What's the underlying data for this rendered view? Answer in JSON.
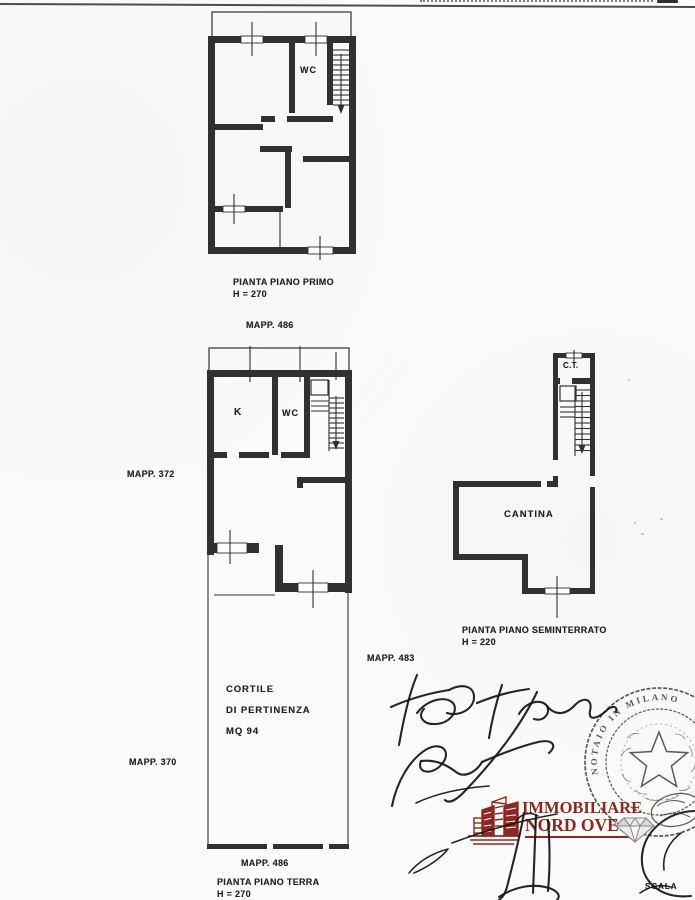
{
  "colors": {
    "ink": "#222222",
    "logo_red": "#8e2722",
    "stamp_ink": "#3f3f3f",
    "paper": "#fbfbf9"
  },
  "plans": {
    "primo": {
      "caption": "PIANTA PIANO PRIMO",
      "height": "H = 270",
      "mapp": "MAPP. 486",
      "room_wc": "WC"
    },
    "terra": {
      "caption": "PIANTA PIANO TERRA",
      "height": "H = 270",
      "mapp": "MAPP. 486",
      "room_k": "K",
      "room_wc": "WC",
      "cortile_line1": "CORTILE",
      "cortile_line2": "DI PERTINENZA",
      "cortile_line3": "MQ 94"
    },
    "seminterrato": {
      "caption": "PIANTA PIANO SEMINTERRATO",
      "height": "H = 220",
      "mapp": "MAPP. 483",
      "room_ct": "C.T.",
      "room_cantina": "CANTINA"
    }
  },
  "margin_labels": {
    "mapp_upper": "MAPP. 372",
    "mapp_lower": "MAPP. 370"
  },
  "logo": {
    "line1": "IMMOBILIARE",
    "line2": "NORD OVEST"
  },
  "stamp": {
    "ring_text": "NOTAIO IN MILANO"
  },
  "footer": {
    "scale_label": "SCALA"
  }
}
